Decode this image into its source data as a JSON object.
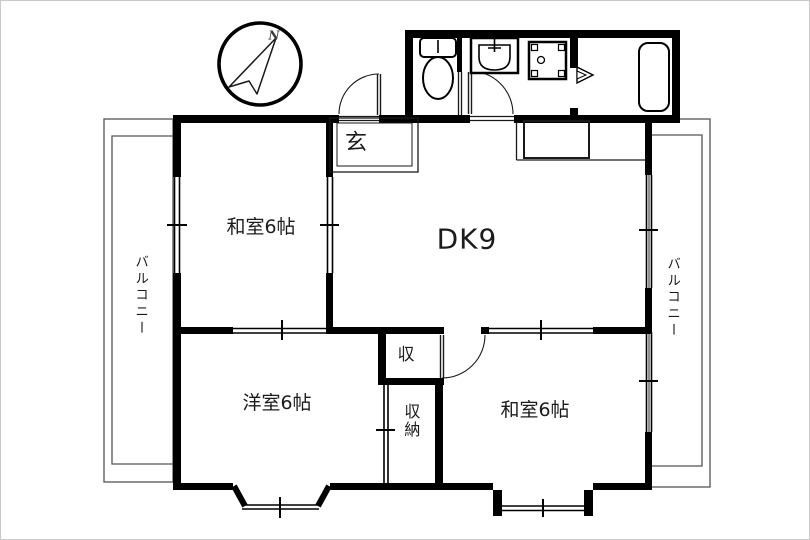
{
  "title": "2DK apartment floor plan",
  "colors": {
    "wall": "#000000",
    "thin_line": "#1a1a1a",
    "balcony_line": "#555555",
    "background": "#ffffff",
    "text": "#1c1c1c"
  },
  "compass": {
    "label": "N"
  },
  "rooms": {
    "entrance": {
      "label": "玄"
    },
    "dining_kitchen": {
      "label": "DK9"
    },
    "japanese_room_top": {
      "label": "和室6帖"
    },
    "western_room": {
      "label": "洋室6帖"
    },
    "japanese_room_bottom": {
      "label": "和室6帖"
    },
    "closet_small": {
      "label": "収"
    },
    "closet_tall": {
      "label": "収納"
    },
    "balcony_left": {
      "label": "バルコニー"
    },
    "balcony_right": {
      "label": "バルコニー"
    }
  }
}
